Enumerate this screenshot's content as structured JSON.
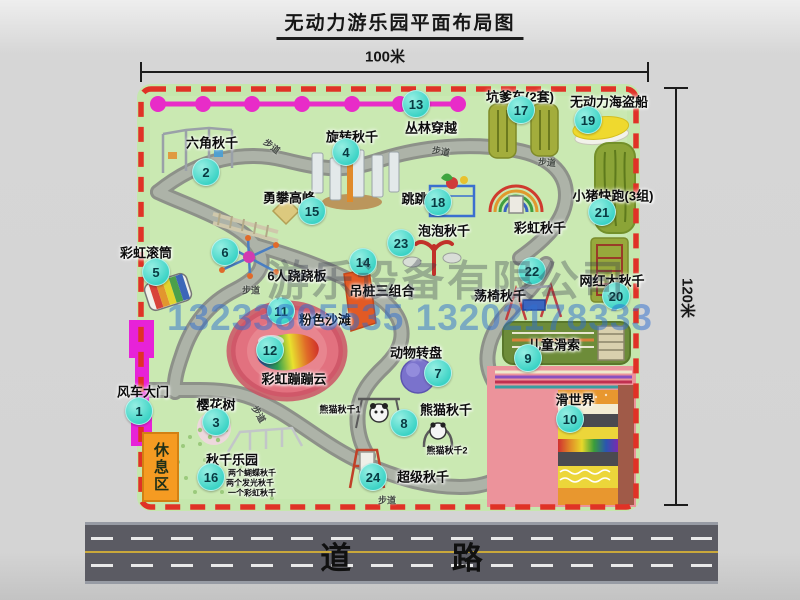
{
  "title": "无动力游乐园平面布局图",
  "dimensions": {
    "width": "100米",
    "height": "120米"
  },
  "road": {
    "label": "道 路"
  },
  "rest_area": {
    "label": "休息区"
  },
  "path_label": "步道",
  "watermark": {
    "company": "游乐设备有限公司",
    "phone": "13233805535 13202178333"
  },
  "colors": {
    "badge-cyan": "#38d2c4",
    "border-red": "#e03226",
    "map-green": "#c5e7ad",
    "road-gray": "#5b5b63",
    "flag-magenta": "#e82cc8",
    "rest-orange": "#f59b22",
    "watermark-blue": "#2f6fd0",
    "beach-pink": "#e2717f"
  },
  "attractions": [
    {
      "num": "1",
      "name": "风车大门",
      "badge": [
        139,
        411
      ],
      "label": [
        143,
        391
      ]
    },
    {
      "num": "2",
      "name": "六角秋千",
      "badge": [
        206,
        172
      ],
      "label": [
        212,
        142
      ]
    },
    {
      "num": "3",
      "name": "樱花树",
      "badge": [
        216,
        422
      ],
      "label": [
        216,
        404
      ]
    },
    {
      "num": "4",
      "name": "旋转秋千",
      "badge": [
        346,
        152
      ],
      "label": [
        352,
        136
      ]
    },
    {
      "num": "5",
      "name": "彩虹滚筒",
      "badge": [
        156,
        272
      ],
      "label": [
        146,
        252
      ]
    },
    {
      "num": "6",
      "name": "6人跷跷板",
      "badge": [
        225,
        252
      ],
      "label": [
        297,
        275
      ]
    },
    {
      "num": "7",
      "name": "动物转盘",
      "badge": [
        438,
        373
      ],
      "label": [
        416,
        352
      ]
    },
    {
      "num": "8",
      "name": "熊猫秋千",
      "badge": [
        404,
        423
      ],
      "label": [
        446,
        409
      ]
    },
    {
      "num": "9",
      "name": "儿童滑索",
      "badge": [
        528,
        358
      ],
      "label": [
        554,
        344
      ]
    },
    {
      "num": "10",
      "name": "滑世界",
      "badge": [
        570,
        419
      ],
      "label": [
        575,
        399
      ]
    },
    {
      "num": "11",
      "name": "粉色沙滩",
      "badge": [
        281,
        311
      ],
      "label": [
        325,
        319
      ]
    },
    {
      "num": "12",
      "name": "彩虹蹦蹦云",
      "badge": [
        270,
        350
      ],
      "label": [
        294,
        378
      ]
    },
    {
      "num": "13",
      "name": "丛林穿越",
      "badge": [
        416,
        104
      ],
      "label": [
        431,
        127
      ]
    },
    {
      "num": "14",
      "name": "吊桩三组合",
      "badge": [
        363,
        262
      ],
      "label": [
        382,
        290
      ]
    },
    {
      "num": "15",
      "name": "勇攀高峰",
      "badge": [
        312,
        211
      ],
      "label": [
        289,
        197
      ]
    },
    {
      "num": "16",
      "name": "秋千乐园",
      "badge": [
        211,
        477
      ],
      "label": [
        232,
        459
      ]
    },
    {
      "num": "17",
      "name": "坑爹车(2套)",
      "badge": [
        521,
        110
      ],
      "label": [
        520,
        96
      ]
    },
    {
      "num": "18",
      "name": "跳跳马",
      "badge": [
        438,
        202
      ],
      "label": [
        421,
        198
      ]
    },
    {
      "num": "19",
      "name": "无动力海盗船",
      "badge": [
        588,
        120
      ],
      "label": [
        609,
        101
      ]
    },
    {
      "num": "20",
      "name": "网红大秋千",
      "badge": [
        616,
        296
      ],
      "label": [
        612,
        280
      ]
    },
    {
      "num": "21",
      "name": "小猪快跑(3组)",
      "badge": [
        602,
        212
      ],
      "label": [
        613,
        195
      ]
    },
    {
      "num": "22",
      "name": "荡椅秋千",
      "badge": [
        532,
        271
      ],
      "label": [
        500,
        295
      ]
    },
    {
      "num": "23",
      "name": "泡泡秋千",
      "badge": [
        401,
        243
      ],
      "label": [
        444,
        230
      ]
    },
    {
      "num": "24",
      "name": "超级秋千",
      "badge": [
        373,
        477
      ],
      "label": [
        423,
        476
      ]
    }
  ],
  "extra_labels": [
    {
      "text": "彩虹秋千",
      "x": 540,
      "y": 227,
      "size": 13
    },
    {
      "text": "熊猫秋千1",
      "x": 340,
      "y": 409,
      "size": 9
    },
    {
      "text": "熊猫秋千2",
      "x": 447,
      "y": 450,
      "size": 9
    },
    {
      "text": "两个蝴蝶秋千",
      "x": 252,
      "y": 473,
      "size": 8
    },
    {
      "text": "两个发光秋千",
      "x": 250,
      "y": 483,
      "size": 8
    },
    {
      "text": "一个彩虹秋千",
      "x": 252,
      "y": 493,
      "size": 8
    }
  ],
  "trail_labels": [
    {
      "x": 272,
      "y": 146,
      "rot": 38
    },
    {
      "x": 441,
      "y": 151,
      "rot": 10
    },
    {
      "x": 547,
      "y": 162,
      "rot": 5
    },
    {
      "x": 251,
      "y": 290,
      "rot": 0
    },
    {
      "x": 259,
      "y": 414,
      "rot": 60
    },
    {
      "x": 387,
      "y": 500,
      "rot": 0
    }
  ]
}
